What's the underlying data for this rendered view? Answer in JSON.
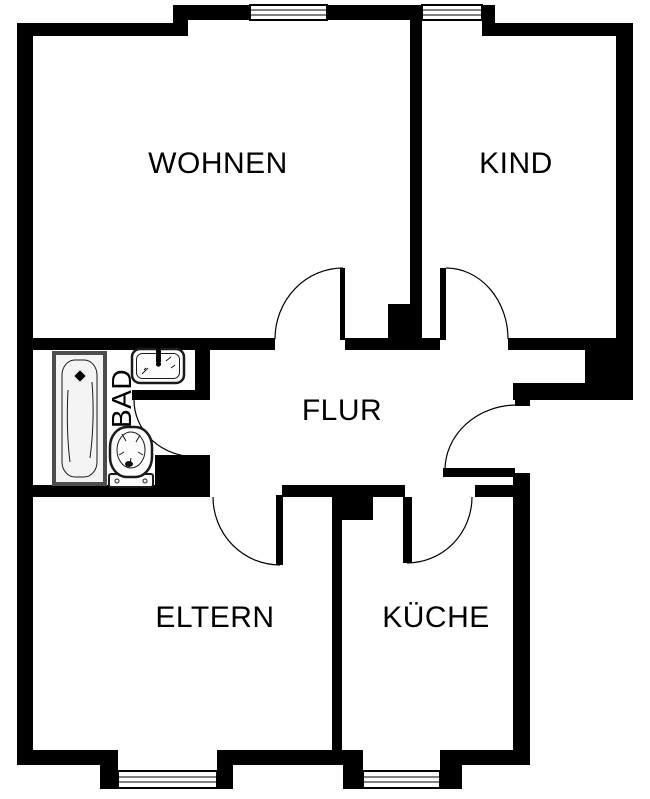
{
  "floorplan": {
    "kind": "apartment-floor-plan",
    "rooms": {
      "living": {
        "label": "WOHNEN"
      },
      "child": {
        "label": "KIND"
      },
      "hall": {
        "label": "FLUR"
      },
      "bath": {
        "label": "BAD"
      },
      "parents": {
        "label": "ELTERN"
      },
      "kitchen": {
        "label": "KÜCHE"
      }
    },
    "fixtures": [
      {
        "icon": "bathtub-icon"
      },
      {
        "icon": "sink-icon"
      },
      {
        "icon": "toilet-icon"
      }
    ],
    "colors": {
      "wall": "#000000",
      "room_fill": "#ffffff",
      "tub_border": "#4d4d4d",
      "fixture_line": "#1a1a1a"
    }
  }
}
